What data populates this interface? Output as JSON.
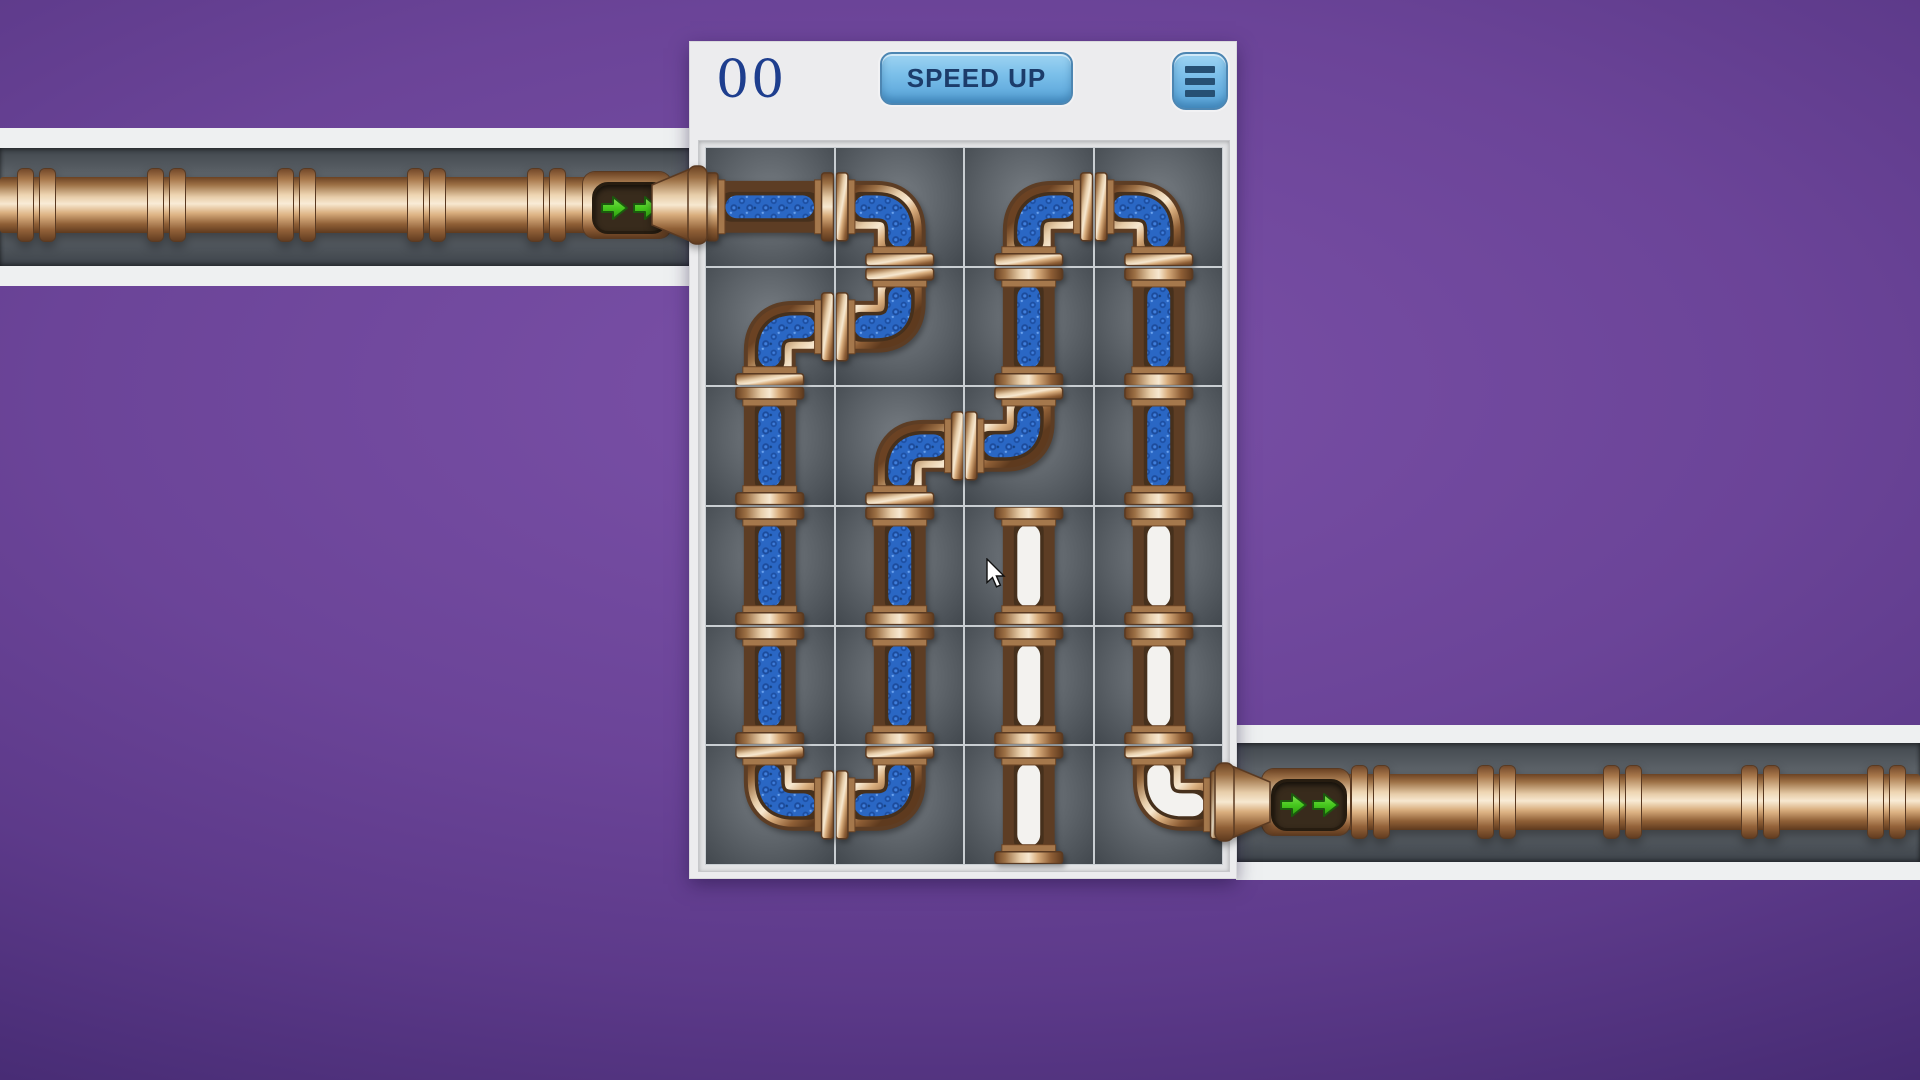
{
  "hud": {
    "score": "00",
    "speed_up_label": "SPEED UP",
    "menu_icon": "hamburger-icon"
  },
  "board": {
    "cols": 4,
    "rows": 6,
    "cells": [
      [
        {
          "pipe": "straight",
          "orient": "h",
          "filled": true
        },
        {
          "pipe": "elbow",
          "conn": [
            "left",
            "bottom"
          ],
          "filled": true
        },
        {
          "pipe": "elbow",
          "conn": [
            "bottom",
            "right"
          ],
          "filled": true
        },
        {
          "pipe": "elbow",
          "conn": [
            "left",
            "bottom"
          ],
          "filled": true
        }
      ],
      [
        {
          "pipe": "elbow",
          "conn": [
            "right",
            "bottom"
          ],
          "filled": true
        },
        {
          "pipe": "elbow",
          "conn": [
            "left",
            "top"
          ],
          "filled": true
        },
        {
          "pipe": "straight",
          "orient": "v",
          "filled": true
        },
        {
          "pipe": "straight",
          "orient": "v",
          "filled": true
        }
      ],
      [
        {
          "pipe": "straight",
          "orient": "v",
          "filled": true
        },
        {
          "pipe": "elbow",
          "conn": [
            "bottom",
            "right"
          ],
          "filled": true
        },
        {
          "pipe": "elbow",
          "conn": [
            "left",
            "top"
          ],
          "filled": true
        },
        {
          "pipe": "straight",
          "orient": "v",
          "filled": true
        }
      ],
      [
        {
          "pipe": "straight",
          "orient": "v",
          "filled": true
        },
        {
          "pipe": "straight",
          "orient": "v",
          "filled": true
        },
        {
          "pipe": "straight",
          "orient": "v",
          "filled": false
        },
        {
          "pipe": "straight",
          "orient": "v",
          "filled": false
        }
      ],
      [
        {
          "pipe": "straight",
          "orient": "v",
          "filled": true
        },
        {
          "pipe": "straight",
          "orient": "v",
          "filled": true
        },
        {
          "pipe": "straight",
          "orient": "v",
          "filled": false
        },
        {
          "pipe": "straight",
          "orient": "v",
          "filled": false
        }
      ],
      [
        {
          "pipe": "elbow",
          "conn": [
            "top",
            "right"
          ],
          "filled": true
        },
        {
          "pipe": "elbow",
          "conn": [
            "left",
            "top"
          ],
          "filled": true
        },
        {
          "pipe": "straight",
          "orient": "v",
          "filled": false
        },
        {
          "pipe": "elbow",
          "conn": [
            "top",
            "right"
          ],
          "filled": false
        }
      ]
    ]
  },
  "inlet": {
    "side": "left",
    "flow_direction": "right",
    "arrow_count": 2
  },
  "outlet": {
    "side": "right",
    "flow_direction": "right",
    "arrow_count": 2
  },
  "cursor": {
    "x": 986,
    "y": 558
  },
  "colors": {
    "background_purple": "#6b4498",
    "panel": "#ececee",
    "copper_light": "#f7e8d0",
    "copper_dark": "#5e3a1e",
    "water_blue": "#2a67c4",
    "empty_pipe": "#f3f2ef",
    "button_blue": "#7cc0ea",
    "score_navy": "#1e3e8e",
    "arrow_green": "#46c81e"
  }
}
